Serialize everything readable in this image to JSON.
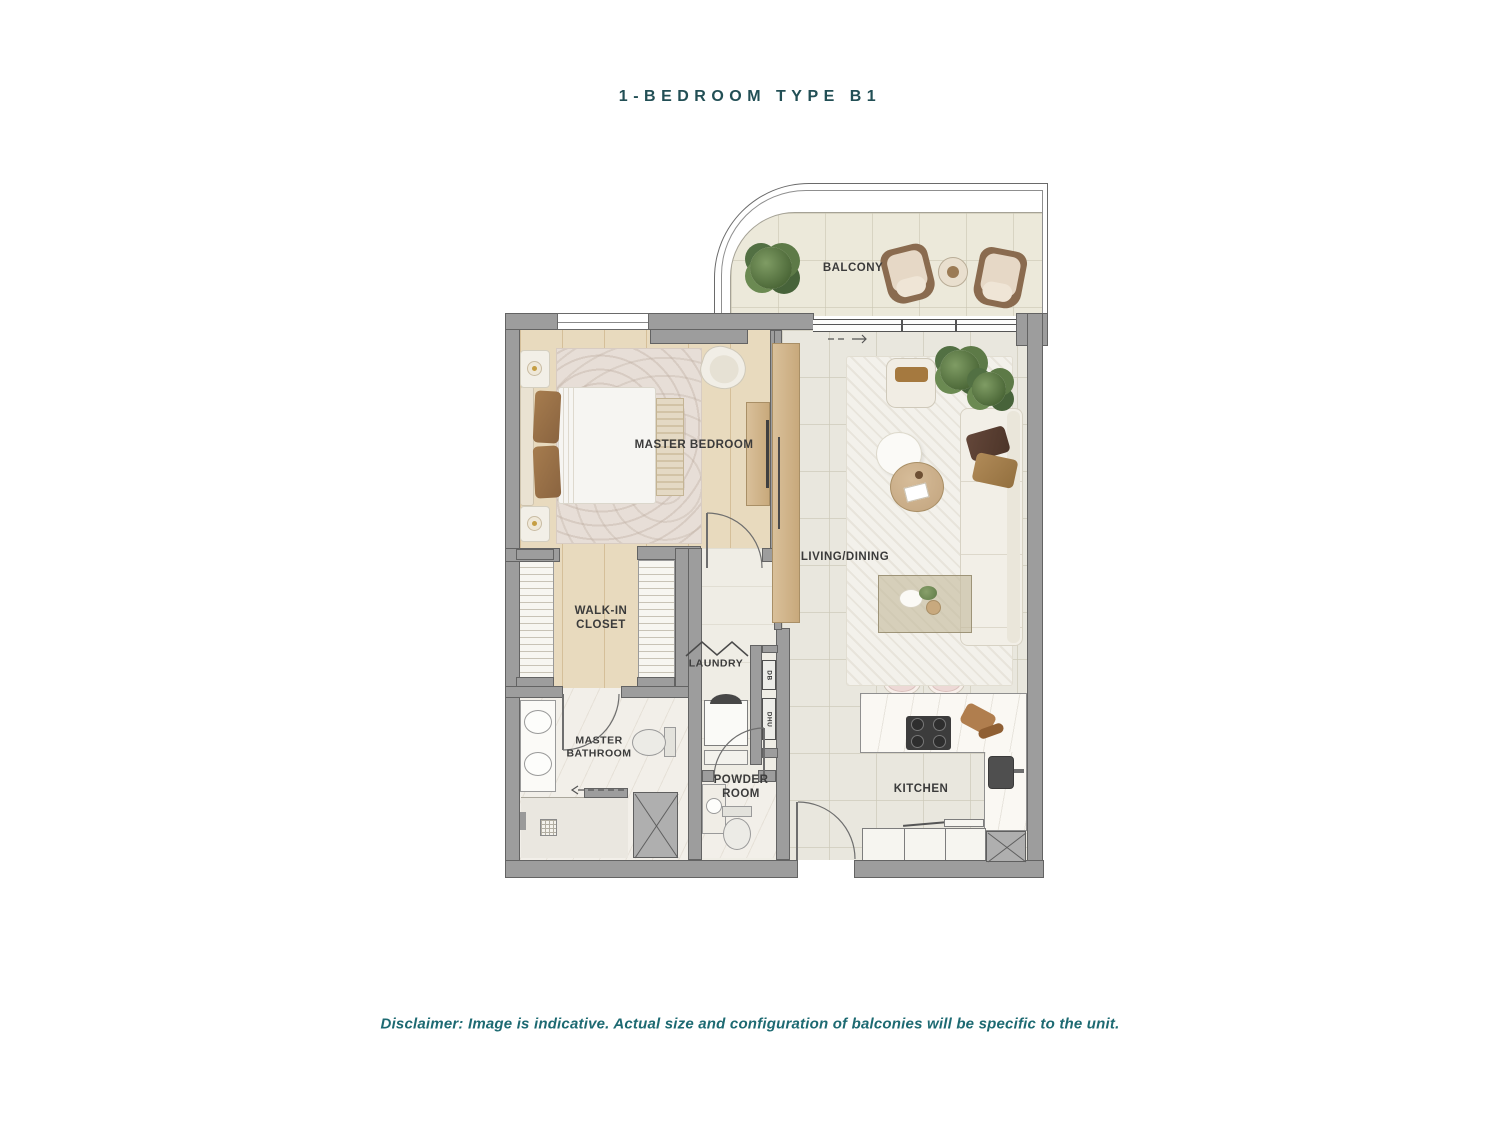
{
  "header": {
    "title": "1-BEDROOM TYPE B1"
  },
  "footer": {
    "disclaimer": "Disclaimer: Image is indicative. Actual size and configuration of balconies will be specific to the unit."
  },
  "rooms": {
    "balcony": {
      "label": "BALCONY"
    },
    "master_bedroom": {
      "label": "MASTER BEDROOM"
    },
    "living_dining": {
      "label": "LIVING/DINING"
    },
    "walk_in_closet": {
      "label": "WALK-IN\nCLOSET"
    },
    "laundry": {
      "label": "LAUNDRY"
    },
    "master_bathroom": {
      "label": "MASTER\nBATHROOM"
    },
    "powder_room": {
      "label": "POWDER\nROOM"
    },
    "kitchen": {
      "label": "KITCHEN"
    }
  },
  "utilities": {
    "db": "DB",
    "dhu": "DHU"
  },
  "colors": {
    "accent_teal": "#224F55",
    "disclaimer_teal": "#1D6A72",
    "wall_gray": "#9D9D9D",
    "wood_floor": "#E8DABE",
    "tile_floor": "#E9E7DE",
    "balcony_floor": "#ECE9DA",
    "label_text": "#3B3B3B"
  }
}
